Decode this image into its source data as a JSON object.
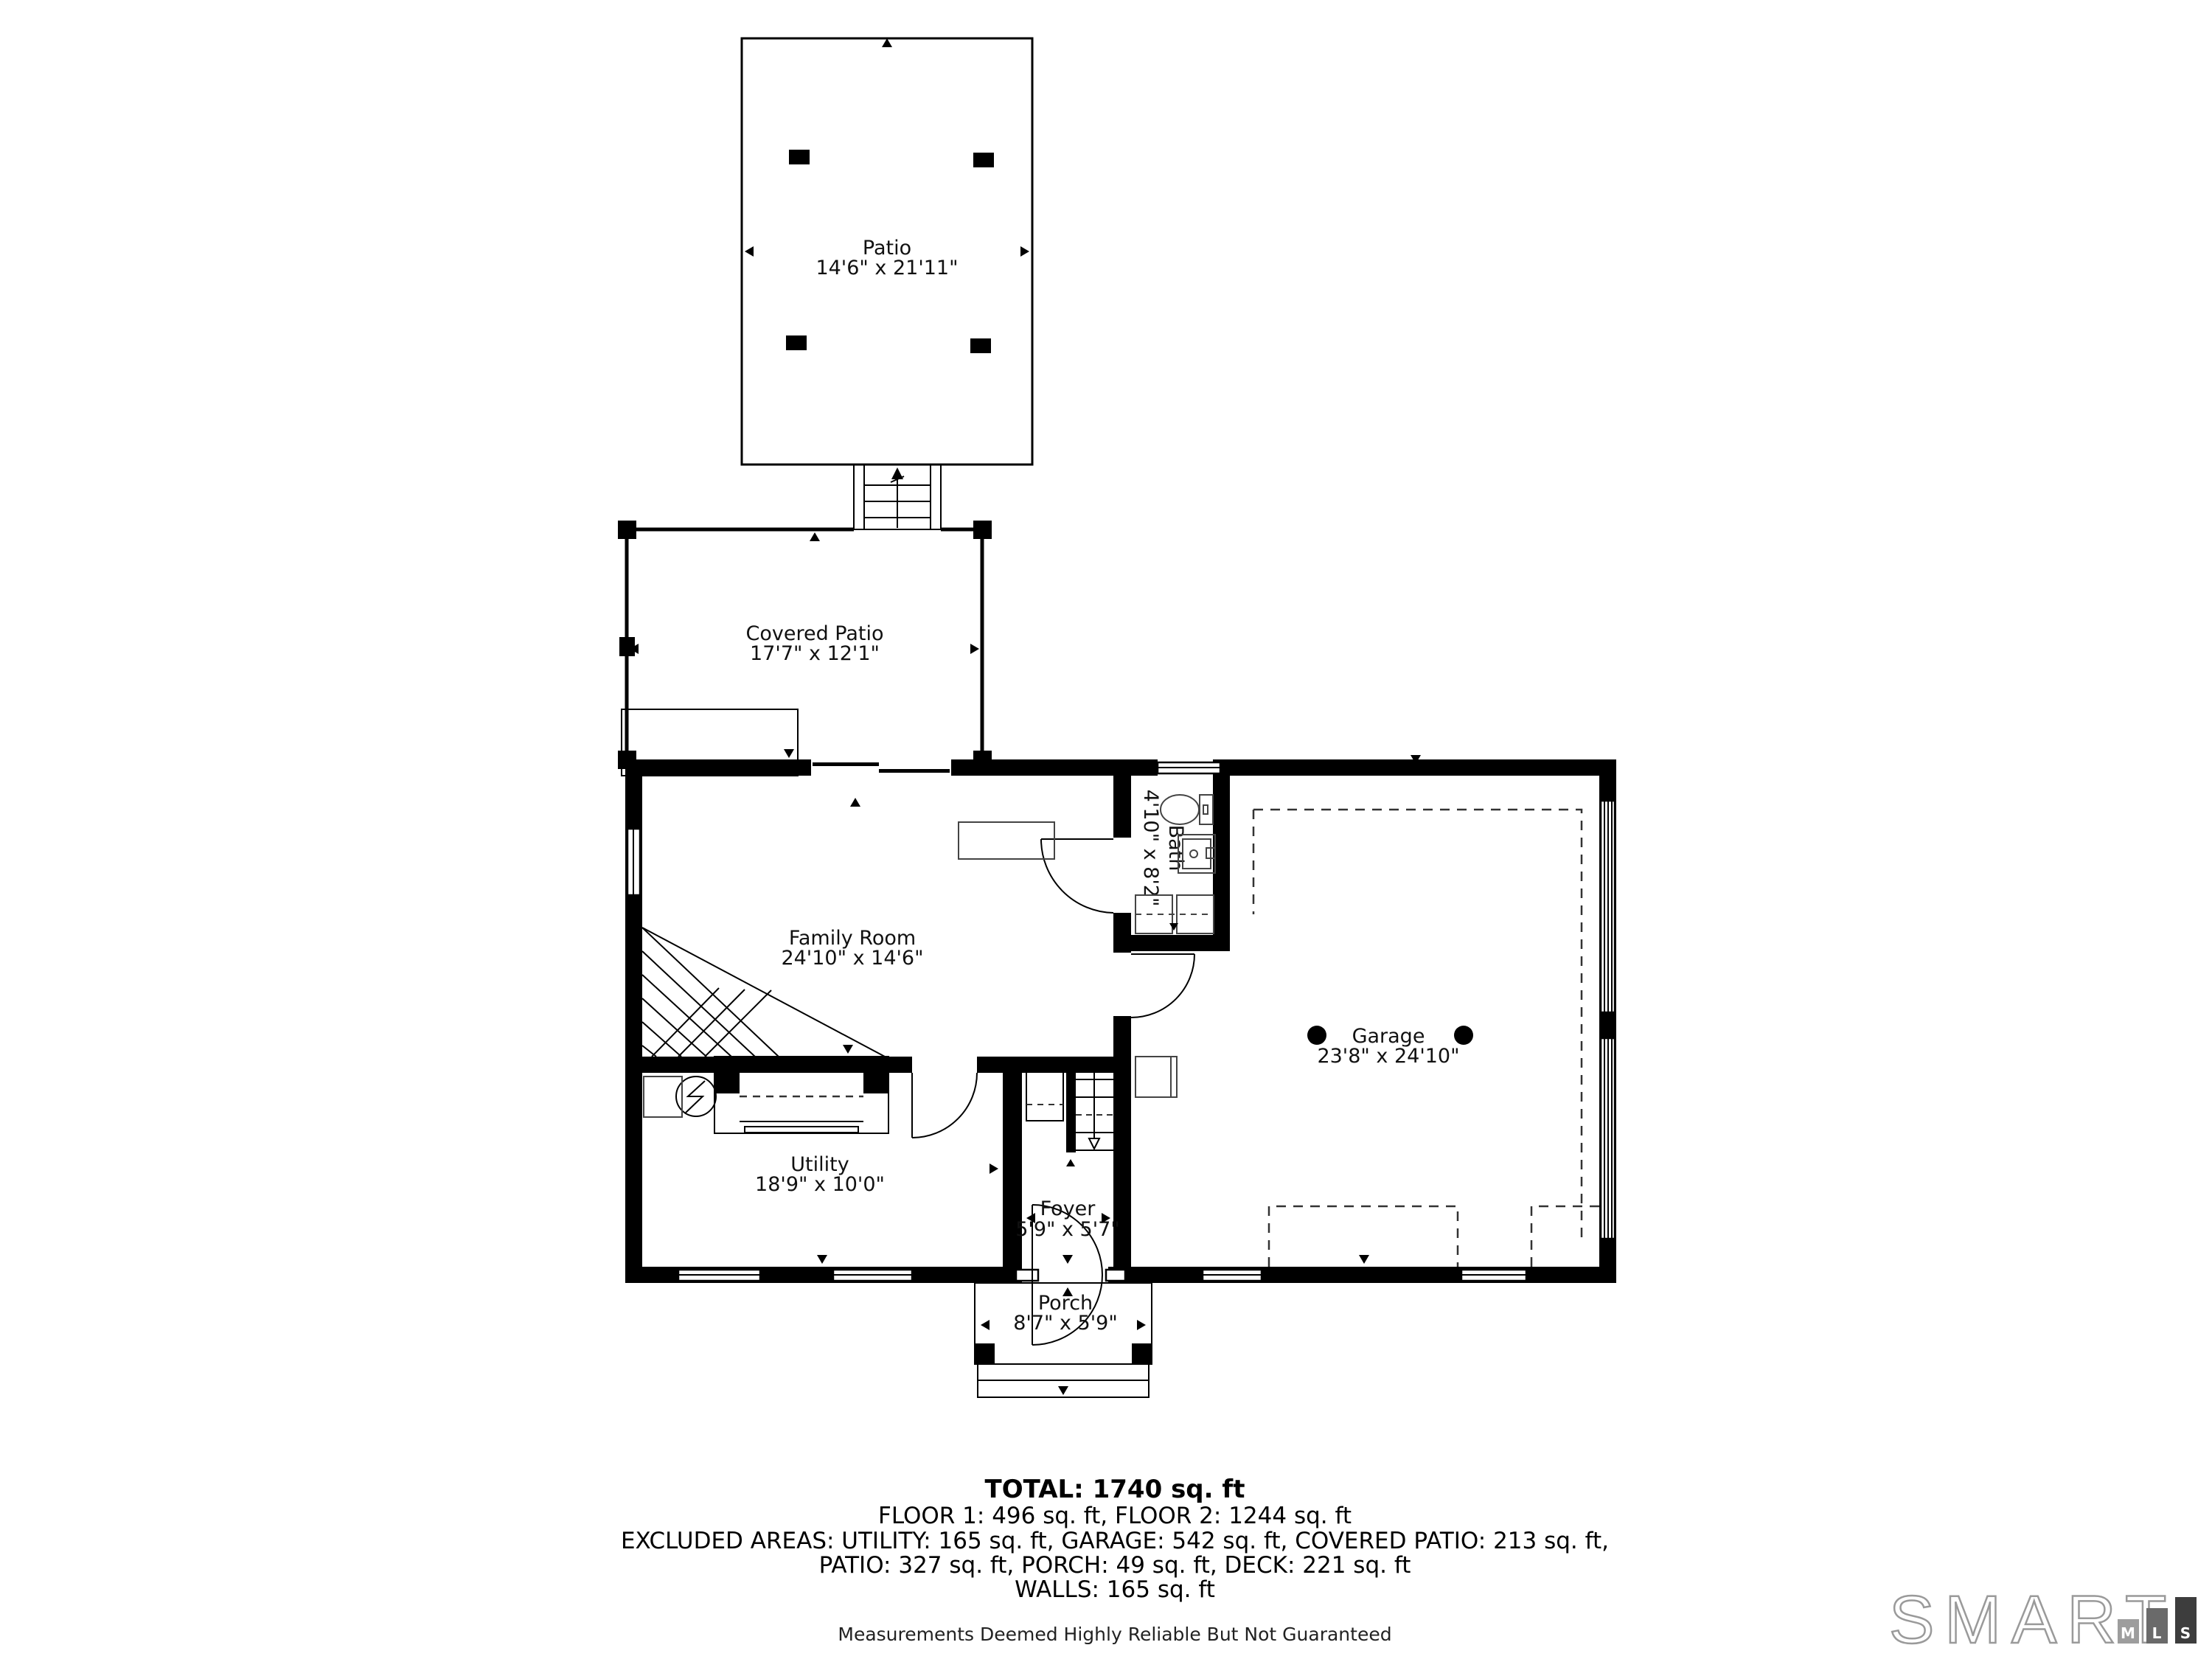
{
  "rooms": {
    "patio": {
      "name": "Patio",
      "dims": "14'6\" x 21'11\""
    },
    "covered_patio": {
      "name": "Covered Patio",
      "dims": "17'7\" x 12'1\""
    },
    "family_room": {
      "name": "Family Room",
      "dims": "24'10\" x 14'6\""
    },
    "bath": {
      "name": "Bath",
      "dims": "4'10\" x 8'2\""
    },
    "garage": {
      "name": "Garage",
      "dims": "23'8\" x 24'10\""
    },
    "utility": {
      "name": "Utility",
      "dims": "18'9\" x 10'0\""
    },
    "foyer": {
      "name": "Foyer",
      "dims": "5'9\" x 5'7\""
    },
    "porch": {
      "name": "Porch",
      "dims": "8'7\" x 5'9\""
    }
  },
  "summary": {
    "total": "TOTAL: 1740 sq. ft",
    "floors": "FLOOR 1: 496 sq. ft, FLOOR 2: 1244 sq. ft",
    "excluded_line1": "EXCLUDED AREAS: UTILITY: 165 sq. ft, GARAGE: 542 sq. ft, COVERED PATIO: 213 sq. ft,",
    "excluded_line2": "PATIO: 327 sq. ft, PORCH: 49 sq. ft, DECK: 221 sq. ft",
    "walls": "WALLS: 165 sq. ft",
    "disclaimer": "Measurements Deemed Highly Reliable But Not Guaranteed"
  },
  "logo": {
    "brand": "SMART",
    "bars": [
      {
        "letter": "M",
        "color": "#9d9d9d"
      },
      {
        "letter": "L",
        "color": "#6a6a6a"
      },
      {
        "letter": "S",
        "color": "#3d3d3d"
      }
    ]
  },
  "colors": {
    "wall": "#000000",
    "text": "#111111",
    "logo_outline": "#9a9a9a",
    "background": "#ffffff"
  }
}
